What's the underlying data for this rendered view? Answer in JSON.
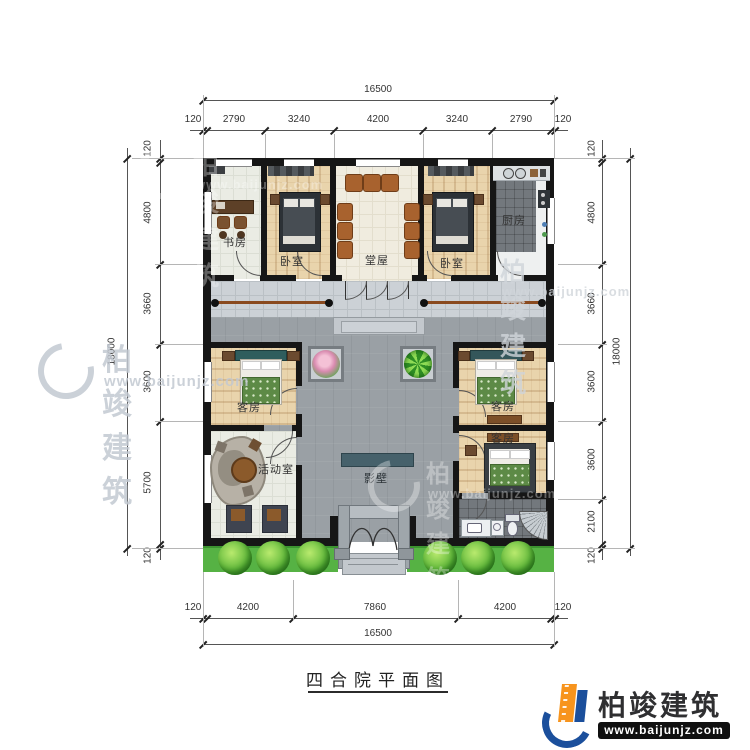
{
  "title": {
    "text": "四合院平面图"
  },
  "logo": {
    "name": "柏竣建筑",
    "url": "www.baijunjz.com"
  },
  "watermark": {
    "name": "柏竣建筑",
    "url": "www.baijunjz.com"
  },
  "colors": {
    "wall": "#161616",
    "courtyard": "#9aa0a5",
    "hedge": "#56b244",
    "screen_wall": "#46616b",
    "logo_blue": "#1b4f9c",
    "logo_orange": "#f7941d"
  },
  "dims": {
    "top": {
      "total": "16500",
      "segments": [
        "120",
        "2790",
        "3240",
        "4200",
        "3240",
        "2790",
        "120"
      ]
    },
    "bottom": {
      "total": "16500",
      "segments": [
        "120",
        "4200",
        "7860",
        "4200",
        "120"
      ]
    },
    "left": {
      "total": "18000",
      "segments": [
        "120",
        "4800",
        "3660",
        "3600",
        "5700",
        "120"
      ]
    },
    "right": {
      "total": "18000",
      "segments": [
        "120",
        "4800",
        "3660",
        "3600",
        "3600",
        "2100",
        "120"
      ]
    }
  },
  "rooms": {
    "study": "书房",
    "bedroom_left": "卧室",
    "hall": "堂屋",
    "bedroom_right": "卧室",
    "kitchen": "厨房",
    "guest_left": "客房",
    "guest_right_top": "客房",
    "guest_right_mid": "客房",
    "activity": "活动室",
    "screen_wall": "影壁"
  }
}
